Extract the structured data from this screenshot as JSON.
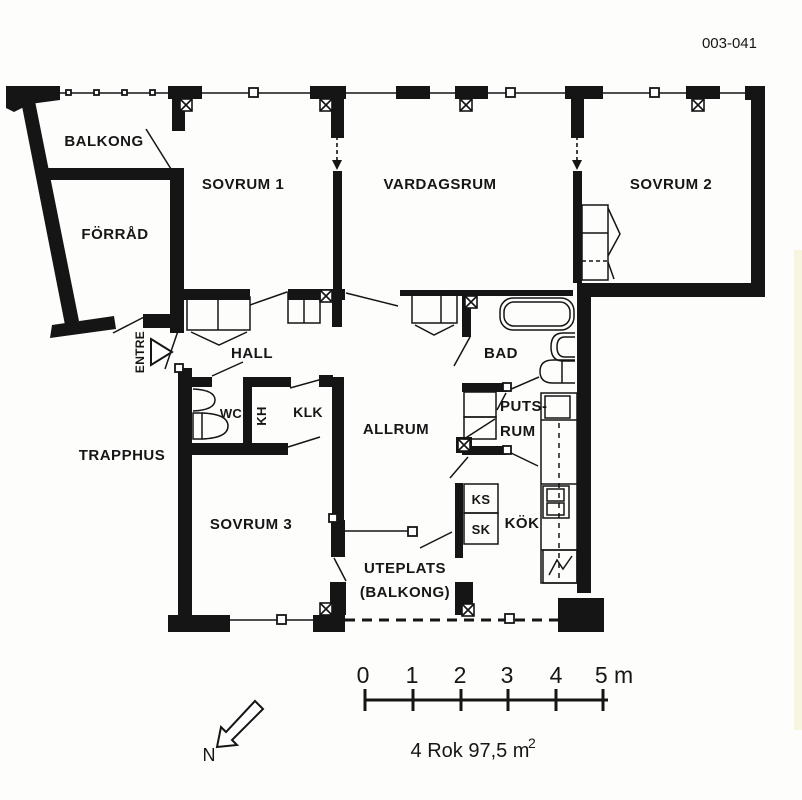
{
  "page": {
    "background": "#fdfdfc",
    "ink": "#161616"
  },
  "header": {
    "drawing_number": "003-041"
  },
  "rooms": {
    "balkong": "BALKONG",
    "forrad": "FÖRRÅD",
    "sovrum1": "SOVRUM 1",
    "vardagsrum": "VARDAGSRUM",
    "sovrum2": "SOVRUM 2",
    "entre": "ENTRE",
    "hall": "HALL",
    "bad": "BAD",
    "wc": "WC",
    "kh": "KH",
    "klk": "KLK",
    "allrum": "ALLRUM",
    "putsrum_line1": "PUTS-",
    "putsrum_line2": "RUM",
    "trapphus": "TRAPPHUS",
    "sovrum3": "SOVRUM 3",
    "ks": "KS",
    "sk": "SK",
    "kok": "KÖK",
    "uteplats_line1": "UTEPLATS",
    "uteplats_line2": "(BALKONG)"
  },
  "scale_bar": {
    "tick_labels": [
      "0",
      "1",
      "2",
      "3",
      "4",
      "5 m"
    ]
  },
  "footer": {
    "area_text": "4 Rok 97,5 m",
    "area_exponent": "2"
  },
  "compass": {
    "north_label": "N"
  }
}
